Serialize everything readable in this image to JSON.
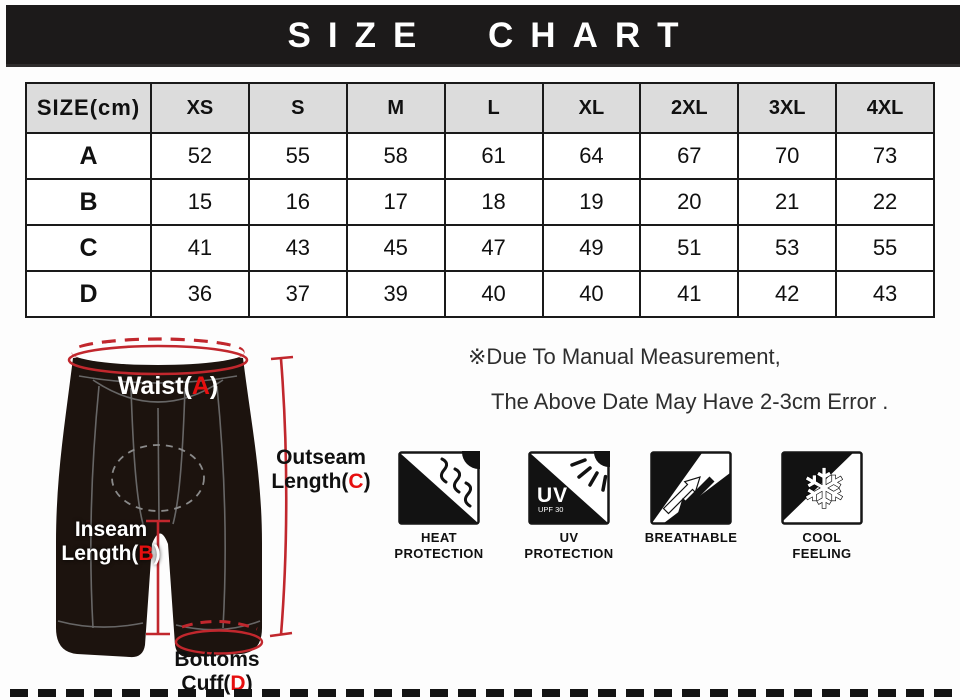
{
  "header": {
    "title": "SIZE CHART"
  },
  "table": {
    "corner": "SIZE(cm)",
    "columns": [
      "XS",
      "S",
      "M",
      "L",
      "XL",
      "2XL",
      "3XL",
      "4XL"
    ],
    "row_labels": [
      "A",
      "B",
      "C",
      "D"
    ]
  },
  "chart_data": {
    "type": "table",
    "title": "SIZE CHART",
    "unit": "cm",
    "columns": [
      "XS",
      "S",
      "M",
      "L",
      "XL",
      "2XL",
      "3XL",
      "4XL"
    ],
    "rows": [
      {
        "label": "A",
        "measure": "Waist",
        "values": [
          52,
          55,
          58,
          61,
          64,
          67,
          70,
          73
        ]
      },
      {
        "label": "B",
        "measure": "Inseam Length",
        "values": [
          15,
          16,
          17,
          18,
          19,
          20,
          21,
          22
        ]
      },
      {
        "label": "C",
        "measure": "Outseam Length",
        "values": [
          41,
          43,
          45,
          47,
          49,
          51,
          53,
          55
        ]
      },
      {
        "label": "D",
        "measure": "Bottoms Cuff",
        "values": [
          36,
          37,
          39,
          40,
          40,
          41,
          42,
          43
        ]
      }
    ]
  },
  "diagram": {
    "waist": {
      "pre": "Waist(",
      "key": "A",
      "post": ")"
    },
    "outseam": {
      "line1": "Outseam",
      "pre": "Length(",
      "key": "C",
      "post": ")"
    },
    "inseam": {
      "line1": "Inseam",
      "pre": "Length(",
      "key": "B",
      "post": ")"
    },
    "cuff": {
      "line1": "Bottoms",
      "pre": "Cuff(",
      "key": "D",
      "post": ")"
    }
  },
  "note": {
    "line1": "※Due To Manual Measurement,",
    "line2": "The Above Date May Have 2-3cm Error ."
  },
  "features": [
    {
      "name": "heat-protection",
      "label_line1": "HEAT",
      "label_line2": "PROTECTION"
    },
    {
      "name": "uv-protection",
      "badge": "UV",
      "badge_sub": "UPF 30",
      "label_line1": "UV",
      "label_line2": "PROTECTION"
    },
    {
      "name": "breathable",
      "label_line1": "BREATHABLE",
      "label_line2": ""
    },
    {
      "name": "cool-feeling",
      "glyph": "❄",
      "label_line1": "COOL",
      "label_line2": "FEELING"
    }
  ],
  "colors": {
    "accent_red": "#e60f0f",
    "measure_red": "#c1272d",
    "bar_black": "#1c1a1a",
    "header_gray": "#dcdcdc",
    "shorts_black": "#1c130e"
  }
}
